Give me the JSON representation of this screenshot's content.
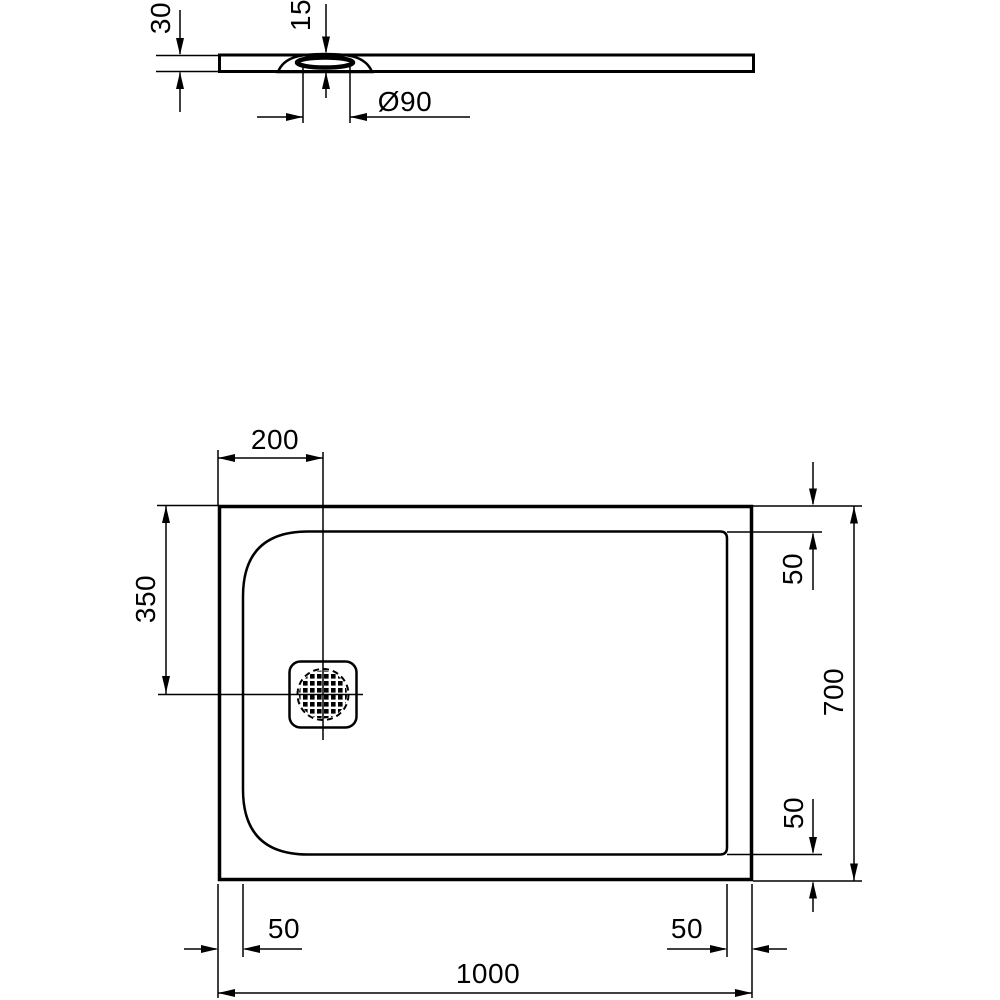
{
  "drawing": {
    "kind": "shower-tray-technical-drawing",
    "units": "mm",
    "line_color": "#000000",
    "background_color": "#ffffff",
    "profile_view": {
      "overall_height": "30",
      "drain_recess_height": "15",
      "drain_diameter": "Ø90"
    },
    "plan_view": {
      "drain_center_from_left": "200",
      "drain_center_from_top": "350",
      "rim_top_right": "50",
      "overall_width": "700",
      "rim_bottom_right": "50",
      "rim_bottom_left_edge": "50",
      "rim_bottom_right_edge": "50",
      "overall_length": "1000"
    }
  }
}
